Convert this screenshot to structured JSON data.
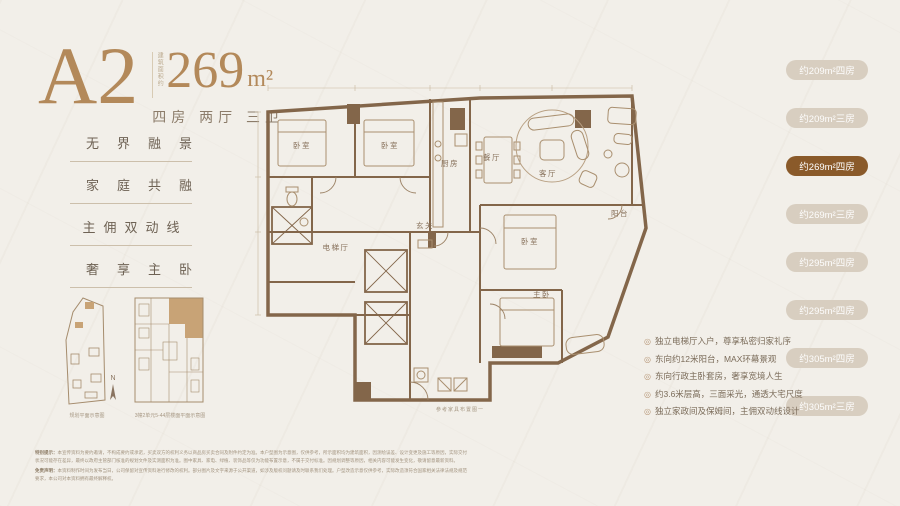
{
  "header": {
    "unit": "A2",
    "area_prefix": "建筑面积约",
    "area_value": "269",
    "area_unit": "m²",
    "layout": "四房 两厅 三卫"
  },
  "features": [
    "无界融景",
    "家庭共融",
    "主佣双动线",
    "奢享主卧"
  ],
  "plan": {
    "rooms": {
      "bedroom1": "卧室",
      "bedroom2": "卧室",
      "kitchen": "厨房",
      "dining": "餐厅",
      "living": "客厅",
      "balcony": "阳台",
      "foyer": "玄关",
      "elevator_hall": "电梯厅",
      "bedroom3": "卧室",
      "master": "主卧"
    },
    "caption": "参考家具布置图一"
  },
  "minimap": {
    "site_caption": "规划平面示意图",
    "north_label": "N",
    "floor_caption": "3幢2单元5-44层楼面平面示意图"
  },
  "unit_tabs": [
    {
      "label": "约209m²四房",
      "active": false
    },
    {
      "label": "约209m²三房",
      "active": false
    },
    {
      "label": "约269m²四房",
      "active": true
    },
    {
      "label": "约269m²三房",
      "active": false
    },
    {
      "label": "约295m²四房",
      "active": false
    },
    {
      "label": "约295m²四房",
      "active": false
    },
    {
      "label": "约305m²四房",
      "active": false
    },
    {
      "label": "约305m²三房",
      "active": false
    }
  ],
  "selling_points": [
    "独立电梯厅入户，尊享私密归家礼序",
    "东向约12米阳台，MAX环幕景观",
    "东向行政主卧套房，奢享宽境人生",
    "约3.6米层高，三面采光，通透大宅尺度",
    "独立家政间及保姆间，主佣双动线设计"
  ],
  "icons": {
    "bullet": "◎"
  },
  "disclaimer": {
    "p1_label": "特别提示：",
    "p1": "本宣传资料为要约邀请，不构成要约或承诺，买卖双方的权利义务以商品房买卖合同及附件约定为准。本户型图为示意图，仅供参考，所示面积均为建筑面积，因测绘误差、设计变更及施工等原因，实际交付状况可能存在差异，最终以政府主管部门核准的规划文件及实测面积为准。图中家具、家电、绿植、装饰品等仅为功能布置示意，不属于交付标准。因规划调整等原因，相关内容可能发生变化，敬请留意最新资料。",
    "p2_label": "免责声明：",
    "p2": "本资料制作时间为发布当日，公司保留对宣传资料进行修改的权利。部分图片及文字来源于公开渠道，如涉及版权问题请及时联系我们处理。户型改造示意仅供参考，实际改造须符合国家相关法律法规及规范要求，本公司对本资料拥有最终解释权。"
  },
  "colors": {
    "accent_gold": "#b3895a",
    "pill_inactive": "#d8cec0",
    "pill_active": "#8a5a2a",
    "wall_brown": "#83664a",
    "highlight_unit": "#c8a376"
  }
}
